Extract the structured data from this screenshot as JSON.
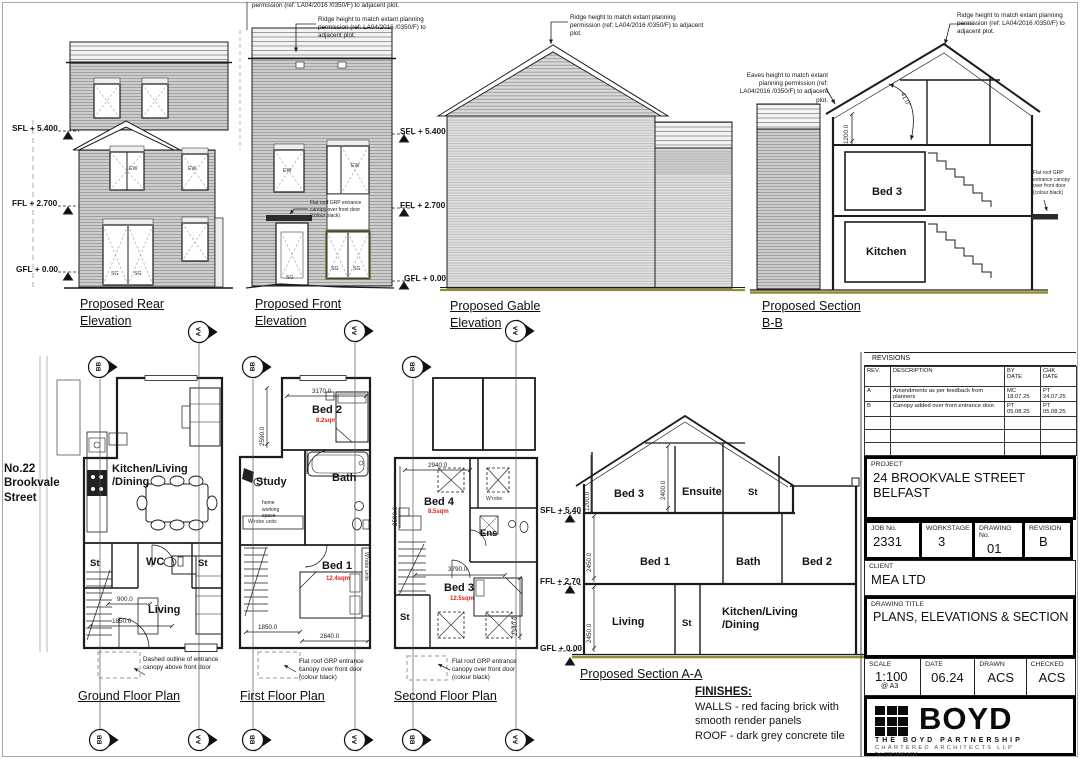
{
  "street_label": "No.22 Brookvale Street",
  "labels": {
    "ew": "EW",
    "sg": "SG",
    "aa": "AA",
    "bb": "BB"
  },
  "levels": {
    "sfl": "SFL + 5.400",
    "ffl": "FFL + 2.700",
    "gfl": "GFL + 0.00",
    "sfl_s": "SFL + 5.40",
    "ffl_s": "FFL + 2.70",
    "gfl_s": "GFL + 0.00"
  },
  "notes": {
    "ridge_partial": "permission (ref: LA04/2016 /0350/F) to adjacent plot.",
    "ridge": "Ridge height to match extant planning permission (ref: LA04/2016 /0350/F) to adjacent plot.",
    "eaves": "Eaves height to match extant planning permission (ref: LA04/2016 /0350/F) to adjacent plot.",
    "canopy": "Flat roof GRP entrance canopy over front door (colour black)",
    "canopy_dashed": "Dashed outline of entrance canopy above front door",
    "wrobe_units": "W'robe units",
    "home_working": "home working space"
  },
  "titles": {
    "rear": "Proposed Rear Elevation",
    "front": "Proposed Front Elevation",
    "gable": "Proposed Gable Elevation",
    "section_bb": "Proposed Section B-B",
    "ground": "Ground Floor Plan",
    "first": "First Floor Plan",
    "second": "Second Floor Plan",
    "section_aa": "Proposed Section A-A"
  },
  "section_bb": {
    "bed3": "Bed 3",
    "kitchen": "Kitchen",
    "dim_eaves": "1200.0",
    "pitch": "41.0°"
  },
  "ground_plan": {
    "kitchen_1": "Kitchen/Living",
    "kitchen_2": "/Dining",
    "st_left": "St",
    "wc": "WC",
    "st_right": "St",
    "living": "Living",
    "dim_900": "900.0",
    "dim_1850": "1850.0"
  },
  "first_plan": {
    "bed2": "Bed 2",
    "bed2_area": "8.2sqm",
    "study": "Study",
    "bath": "Bath",
    "bed1": "Bed 1",
    "bed1_area": "12.4sqm",
    "dim_3170": "3170.0",
    "dim_2590": "2590.0",
    "dim_1850": "1850.0",
    "dim_2840": "2840.0"
  },
  "second_plan": {
    "bed4": "Bed 4",
    "bed4_area": "8.5sqm",
    "wrobe": "W'robe",
    "ens": "Ens",
    "bed3": "Bed 3",
    "bed3_area": "12.5sqm",
    "st": "St",
    "dim_2940": "2940.0",
    "dim_2590": "2590.0",
    "dim_3790": "3790.0",
    "dim_2340": "2340.0"
  },
  "section_aa": {
    "bed3": "Bed 3",
    "ensuite": "Ensuite",
    "st_top": "St",
    "bed1": "Bed 1",
    "bath": "Bath",
    "bed2": "Bed 2",
    "living": "Living",
    "st_ground": "St",
    "kitchen_1": "Kitchen/Living",
    "kitchen_2": "/Dining",
    "dim_knee": "1200.0",
    "dim_2400": "2400.0",
    "dim_first": "2450.0",
    "dim_ground": "2450.0"
  },
  "finishes": {
    "heading": "FINISHES:",
    "walls": "WALLS - red facing brick with smooth render panels",
    "roof": "ROOF - dark grey concrete tile"
  },
  "title_block": {
    "revisions_heading": "REVISIONS",
    "headers": {
      "rev": "REV.",
      "description": "DESCRIPTION",
      "by1": "BY",
      "by2": "DATE",
      "chk1": "CHK",
      "chk2": "DATE"
    },
    "rows": [
      {
        "rev": "A",
        "description": "Amendments as per feedback from planners",
        "by_name": "MC",
        "by_date": "18.07.25",
        "chk_name": "PT",
        "chk_date": "24.07.25"
      },
      {
        "rev": "B",
        "description": "Canopy added over front entrance door.",
        "by_name": "PT",
        "by_date": "05.08.25",
        "chk_name": "PT",
        "chk_date": "05.08.25"
      }
    ],
    "project_label": "PROJECT",
    "project_line1": "24 BROOKVALE STREET",
    "project_line2": "BELFAST",
    "job_label": "JOB No.",
    "job": "2331",
    "workstage_label": "WORKSTAGE",
    "workstage": "3",
    "drawing_no_label": "DRAWING No.",
    "drawing_no": "01",
    "revision_label": "REVISION",
    "revision": "B",
    "client_label": "CLIENT",
    "client": "MEA LTD",
    "drawing_title_label": "DRAWING TITLE",
    "drawing_title": "PLANS, ELEVATIONS & SECTION",
    "scale_label": "SCALE",
    "scale": "1:100",
    "scale_sub": "@ A3",
    "date_label": "DATE",
    "date": "06.24",
    "drawn_label": "DRAWN",
    "drawn": "ACS",
    "checked_label": "CHECKED",
    "checked": "ACS",
    "logo": {
      "name": "BOYD",
      "line1": "THE BOYD PARTNERSHIP",
      "line2": "CHARTERED ARCHITECTS LLP",
      "tel": "Tel: 028 9046 1414"
    }
  }
}
